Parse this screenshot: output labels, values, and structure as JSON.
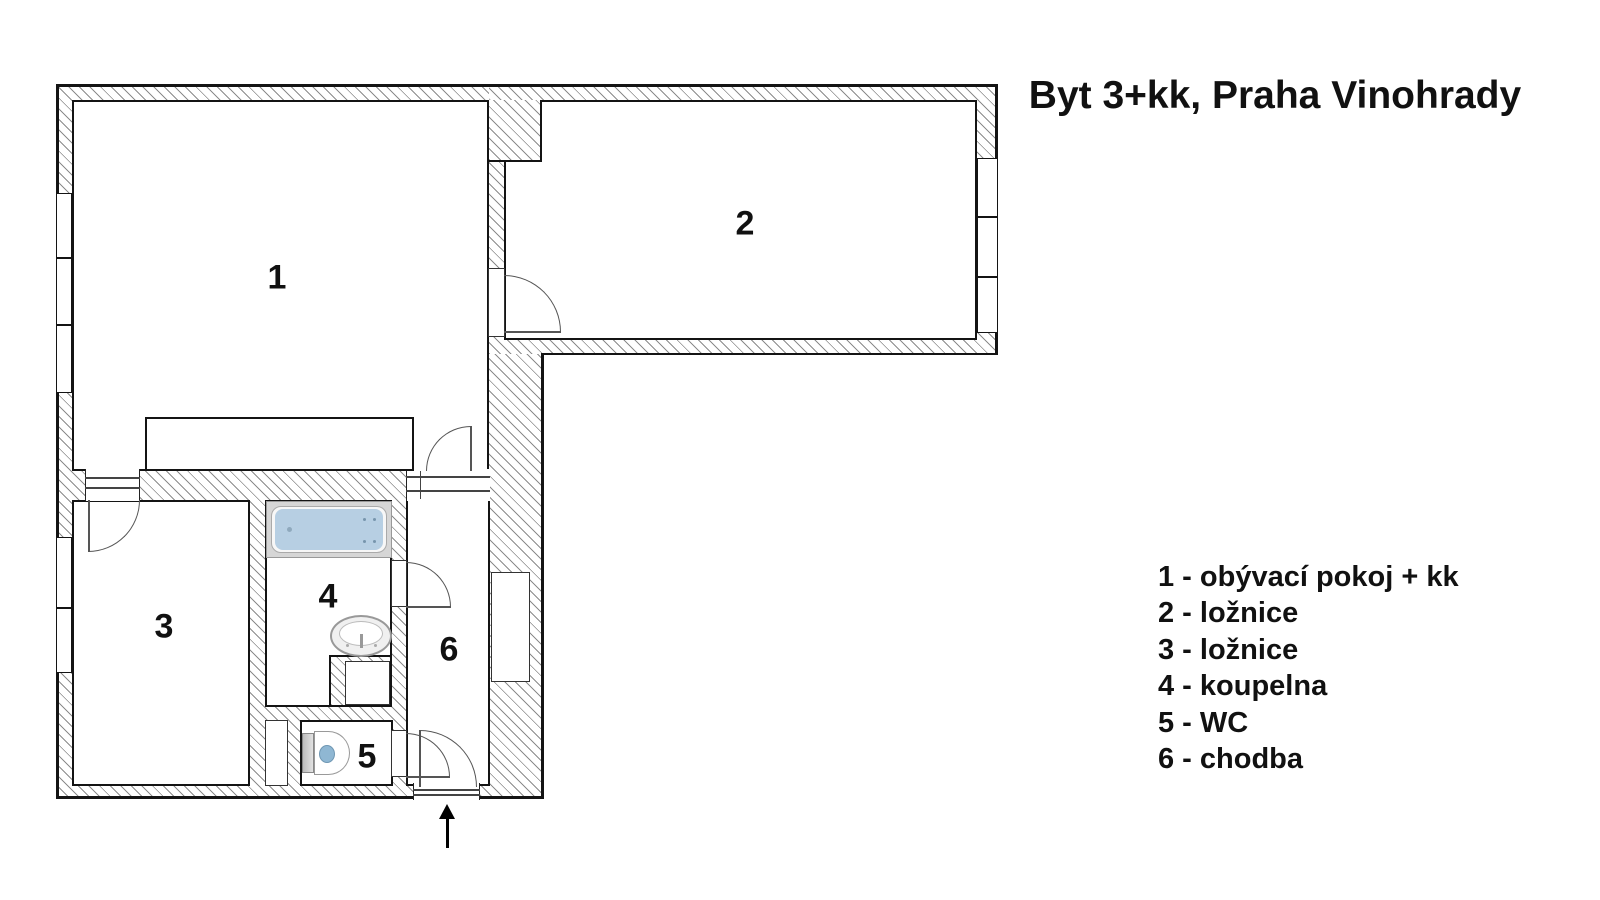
{
  "title": "Byt 3+kk, Praha Vinohrady",
  "rooms": [
    {
      "number": "1",
      "name": "obývací pokoj + kk"
    },
    {
      "number": "2",
      "name": "ložnice"
    },
    {
      "number": "3",
      "name": "ložnice"
    },
    {
      "number": "4",
      "name": "koupelna"
    },
    {
      "number": "5",
      "name": "WC"
    },
    {
      "number": "6",
      "name": "chodba"
    }
  ],
  "legend_items": [
    "1 - obývací pokoj + kk",
    "2 - ložnice",
    "3 - ložnice",
    "4 - koupelna",
    "5 - WC",
    "6 - chodba"
  ],
  "fixtures": [
    "bathtub",
    "washbasin",
    "toilet",
    "kitchen-counter",
    "entrance-arrow"
  ],
  "colors": {
    "outline": "#141414",
    "hatch_line": "#8c8c8c",
    "bathtub_water": "#b7cfe3",
    "toilet_seat": "#8fb7d3"
  }
}
